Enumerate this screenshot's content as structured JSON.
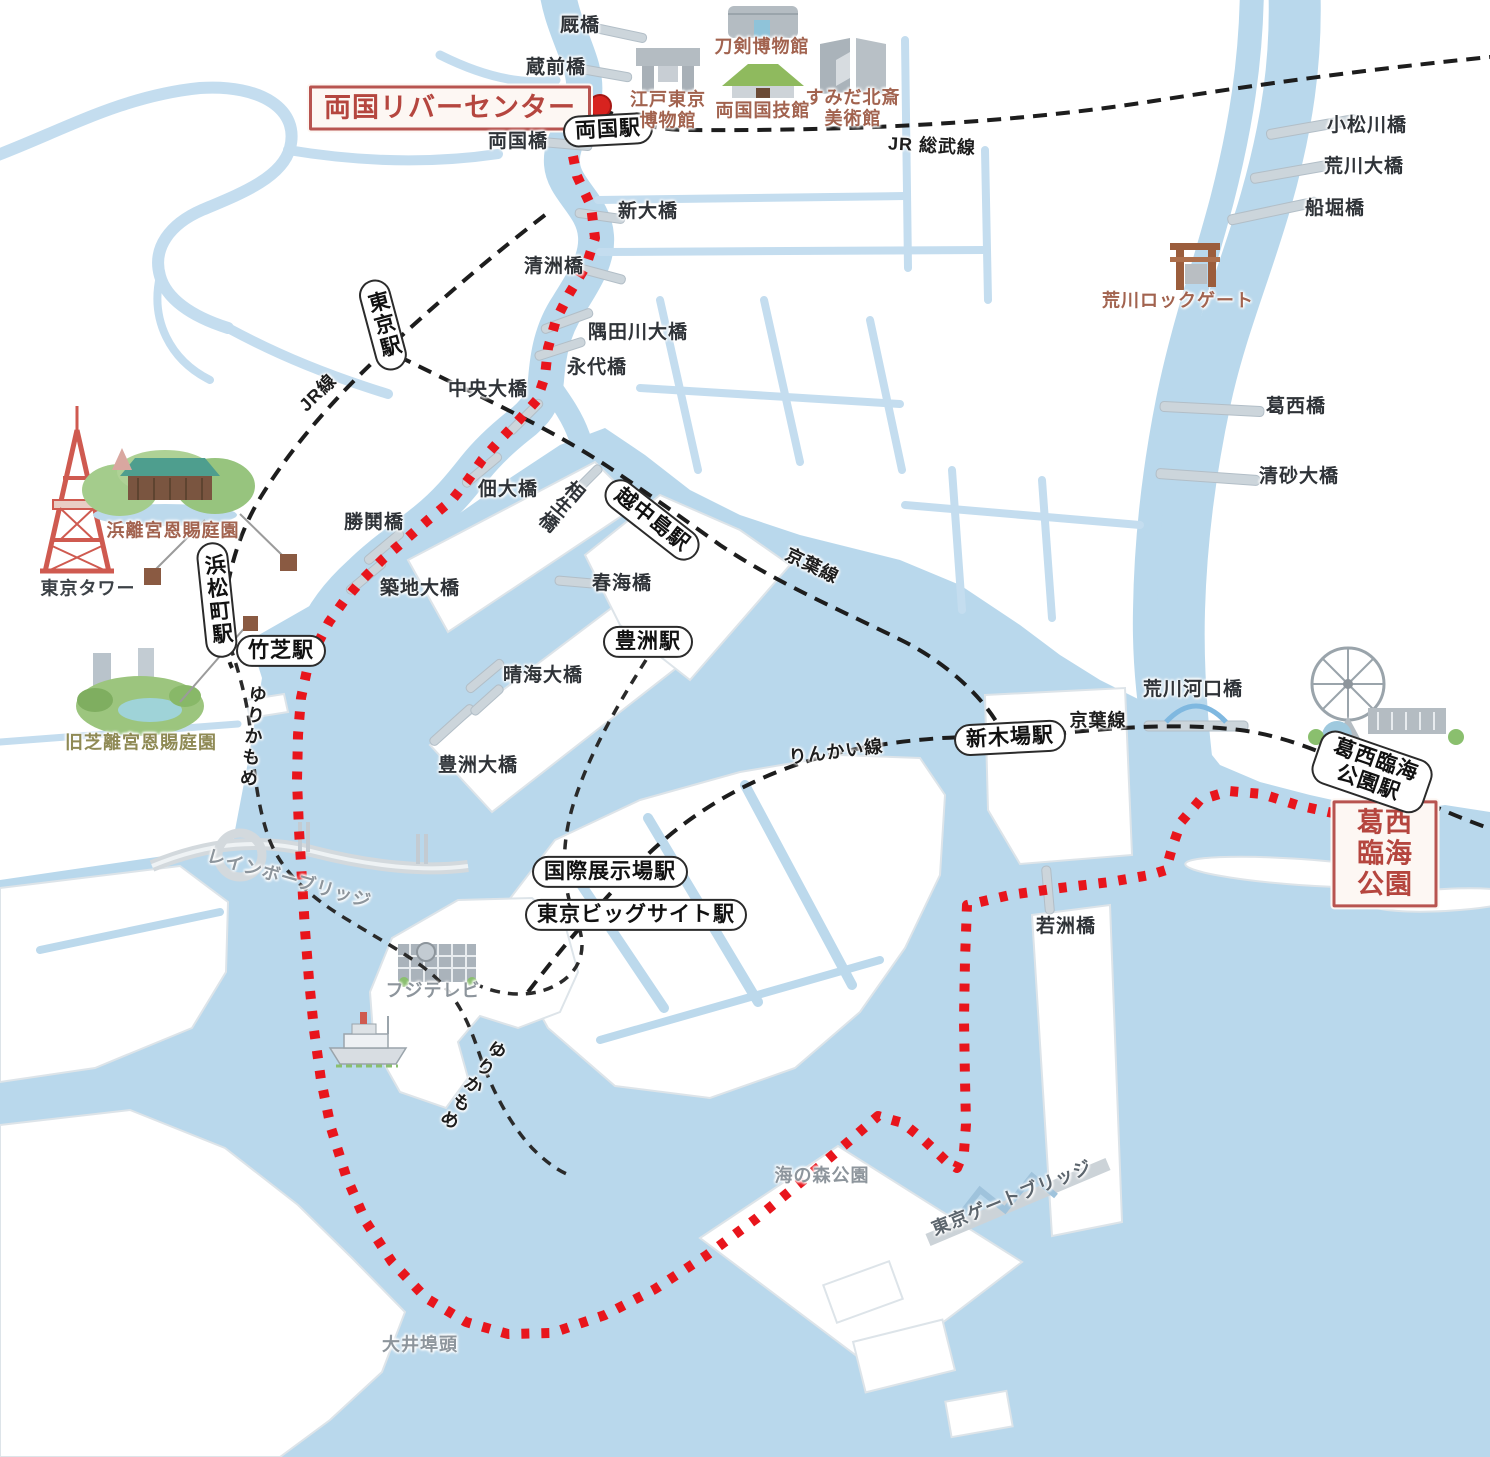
{
  "route": {
    "start": "両国リバーセンター",
    "end": "葛西臨海公園",
    "style": "red-dotted"
  },
  "colors": {
    "water": "#b9d8ec",
    "canal": "#c4ddef",
    "land": "#ffffff",
    "land_stroke": "#dde4e9",
    "route_red": "#e8151c",
    "rail_black": "#1d1d1d",
    "endpoint_red": "#b85450",
    "bridge_bar": "#ccd5db",
    "landmark_brown": "#a2634f"
  },
  "endpoints": [
    {
      "id": "ryogoku-river-center",
      "label": "両国リバーセンター",
      "x": 450,
      "y": 108
    },
    {
      "id": "kasai-rinkai-park",
      "label": "葛西臨海公園",
      "x": 1385,
      "y": 854
    }
  ],
  "stations": [
    {
      "id": "ryogoku-station",
      "label": "両国駅",
      "x": 608,
      "y": 130,
      "rot": -3
    },
    {
      "id": "tokyo-station",
      "label": "東京駅",
      "x": 383,
      "y": 325,
      "rot": -15,
      "vertical": true
    },
    {
      "id": "hamamatsucho-station",
      "label": "浜松町駅",
      "x": 217,
      "y": 600,
      "rot": -6,
      "vertical": true
    },
    {
      "id": "takeshiba-station",
      "label": "竹芝駅",
      "x": 281,
      "y": 651,
      "rot": 0
    },
    {
      "id": "etchujima-station",
      "label": "越中島駅",
      "x": 652,
      "y": 520,
      "rot": 38
    },
    {
      "id": "toyosu-station",
      "label": "豊洲駅",
      "x": 648,
      "y": 642,
      "rot": 0
    },
    {
      "id": "shinkiba-station",
      "label": "新木場駅",
      "x": 1010,
      "y": 738,
      "rot": -3
    },
    {
      "id": "kokusai-tenjijo-station",
      "label": "国際展示場駅",
      "x": 610,
      "y": 872,
      "rot": 0
    },
    {
      "id": "tokyo-big-sight-station",
      "label": "東京ビッグサイト駅",
      "x": 636,
      "y": 915,
      "rot": 0
    },
    {
      "id": "kasai-rinkai-koen-station",
      "label": "葛西臨海公園駅",
      "x": 1372,
      "y": 772,
      "rot": 19
    }
  ],
  "rail_line_labels": [
    {
      "id": "jr-sobu-line",
      "label": "JR 総武線",
      "x": 932,
      "y": 146,
      "rot": 3
    },
    {
      "id": "jr-line",
      "label": "JR線",
      "x": 318,
      "y": 393,
      "rot": -45
    },
    {
      "id": "keiyo-line-west",
      "label": "京葉線",
      "x": 812,
      "y": 566,
      "rot": 26
    },
    {
      "id": "keiyo-line-east",
      "label": "京葉線",
      "x": 1098,
      "y": 721,
      "rot": 0
    },
    {
      "id": "rinkai-line",
      "label": "りんかい線",
      "x": 836,
      "y": 752,
      "rot": -7
    },
    {
      "id": "yurikamome-north",
      "label": "ゆりかもめ",
      "x": 252,
      "y": 737,
      "rot": 6,
      "vertical": true
    },
    {
      "id": "yurikamome-south",
      "label": "ゆりかもめ",
      "x": 472,
      "y": 1085,
      "rot": 34,
      "vertical": true
    }
  ],
  "bridge_labels": [
    {
      "id": "umayabashi",
      "label": "厩橋",
      "x": 580,
      "y": 26
    },
    {
      "id": "kuramaebashi",
      "label": "蔵前橋",
      "x": 556,
      "y": 68
    },
    {
      "id": "ryogokubashi",
      "label": "両国橋",
      "x": 518,
      "y": 142
    },
    {
      "id": "shin-ohashi",
      "label": "新大橋",
      "x": 648,
      "y": 212
    },
    {
      "id": "kiyosubashi",
      "label": "清洲橋",
      "x": 554,
      "y": 267
    },
    {
      "id": "sumidagawa-ohashi",
      "label": "隅田川大橋",
      "x": 638,
      "y": 333
    },
    {
      "id": "eitaibashi",
      "label": "永代橋",
      "x": 597,
      "y": 368
    },
    {
      "id": "chuo-ohashi",
      "label": "中央大橋",
      "x": 488,
      "y": 390
    },
    {
      "id": "tsukuda-ohashi",
      "label": "佃大橋",
      "x": 508,
      "y": 490
    },
    {
      "id": "aioibashi",
      "label": "相生橋",
      "x": 560,
      "y": 505,
      "rot": 40,
      "vertical": true
    },
    {
      "id": "kachidokibashi",
      "label": "勝鬨橋",
      "x": 374,
      "y": 523
    },
    {
      "id": "tsukiji-ohashi",
      "label": "築地大橋",
      "x": 420,
      "y": 589
    },
    {
      "id": "harumibashi",
      "label": "春海橋",
      "x": 622,
      "y": 584
    },
    {
      "id": "harumi-ohashi",
      "label": "晴海大橋",
      "x": 543,
      "y": 676
    },
    {
      "id": "toyosu-ohashi",
      "label": "豊洲大橋",
      "x": 478,
      "y": 766
    },
    {
      "id": "komatsugawabashi",
      "label": "小松川橋",
      "x": 1367,
      "y": 126
    },
    {
      "id": "arakawa-ohashi",
      "label": "荒川大橋",
      "x": 1364,
      "y": 167
    },
    {
      "id": "funaboribashi",
      "label": "船堀橋",
      "x": 1335,
      "y": 209
    },
    {
      "id": "kasaibashi",
      "label": "葛西橋",
      "x": 1296,
      "y": 407
    },
    {
      "id": "kiyosuna-ohashi",
      "label": "清砂大橋",
      "x": 1299,
      "y": 477
    },
    {
      "id": "arakawa-kakokyo",
      "label": "荒川河口橋",
      "x": 1193,
      "y": 690
    },
    {
      "id": "wakasubashi",
      "label": "若洲橋",
      "x": 1066,
      "y": 927
    }
  ],
  "landmark_labels": [
    {
      "id": "edo-tokyo-museum",
      "label": "江戸東京\n博物館",
      "x": 668,
      "y": 110,
      "tone": "brown"
    },
    {
      "id": "token-museum",
      "label": "刀剣博物館",
      "x": 762,
      "y": 47,
      "tone": "brown"
    },
    {
      "id": "ryogoku-kokugikan",
      "label": "両国国技館",
      "x": 763,
      "y": 111,
      "tone": "brown"
    },
    {
      "id": "sumida-hokusai-museum",
      "label": "すみだ北斎\n美術館",
      "x": 853,
      "y": 108,
      "tone": "brown"
    },
    {
      "id": "arakawa-lock-gate",
      "label": "荒川ロックゲート",
      "x": 1178,
      "y": 301,
      "tone": "brown"
    },
    {
      "id": "tokyo-tower",
      "label": "東京タワー",
      "x": 88,
      "y": 589,
      "tone": "dark"
    },
    {
      "id": "hamarikyu-gardens",
      "label": "浜離宮恩賜庭園",
      "x": 173,
      "y": 531,
      "tone": "brown"
    },
    {
      "id": "kyu-shiba-rikyu-gardens",
      "label": "旧芝離宮恩賜庭園",
      "x": 141,
      "y": 743,
      "tone": "olive"
    },
    {
      "id": "fuji-tv",
      "label": "フジテレビ",
      "x": 433,
      "y": 991,
      "tone": "gray"
    },
    {
      "id": "rainbow-bridge",
      "label": "レインボーブリッジ",
      "x": 289,
      "y": 879,
      "rot": 16,
      "tone": "gray"
    },
    {
      "id": "tokyo-gate-bridge",
      "label": "東京ゲートブリッジ",
      "x": 1012,
      "y": 1198,
      "rot": -22,
      "tone": "steel"
    },
    {
      "id": "umi-no-mori-park",
      "label": "海の森公園",
      "x": 822,
      "y": 1176,
      "tone": "gray"
    },
    {
      "id": "oi-wharf",
      "label": "大井埠頭",
      "x": 420,
      "y": 1345,
      "tone": "gray"
    }
  ],
  "icons": [
    {
      "name": "tokyo-tower-icon"
    },
    {
      "name": "hamarikyu-garden-icon"
    },
    {
      "name": "kyu-shiba-garden-icon"
    },
    {
      "name": "edo-tokyo-museum-icon"
    },
    {
      "name": "token-museum-icon"
    },
    {
      "name": "kokugikan-icon"
    },
    {
      "name": "hokusai-museum-icon"
    },
    {
      "name": "arakawa-lock-gate-icon"
    },
    {
      "name": "ferris-wheel-icon"
    },
    {
      "name": "fuji-tv-icon"
    },
    {
      "name": "cruise-ship-icon"
    },
    {
      "name": "rainbow-bridge-icon"
    },
    {
      "name": "gate-bridge-icon"
    },
    {
      "name": "route-start-dot"
    },
    {
      "name": "route-end-dot"
    }
  ]
}
